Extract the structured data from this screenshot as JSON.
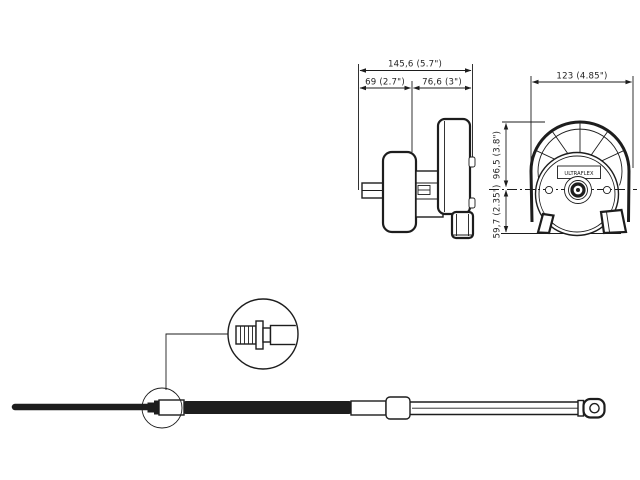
{
  "page": {
    "background_color": "#ffffff",
    "ink_color": "#1d1d1d",
    "description": "Technical dimension drawing of a rotary steering helm (side and front views) with steering cable and magnified connector detail"
  },
  "side_view": {
    "dimensions": {
      "overall_width": "145,6 (5.7\")",
      "left_width": "69 (2.7\")",
      "right_width": "76,6 (3\")"
    }
  },
  "front_view": {
    "brand_label": "ULTRAFLEX",
    "dimensions": {
      "overall_width": "123 (4.85\")",
      "upper_height": "96,5 (3.8\")",
      "lower_height": "59,7 (2.35\")"
    }
  },
  "cable": {
    "detail_callout": "threaded-connector-end"
  }
}
